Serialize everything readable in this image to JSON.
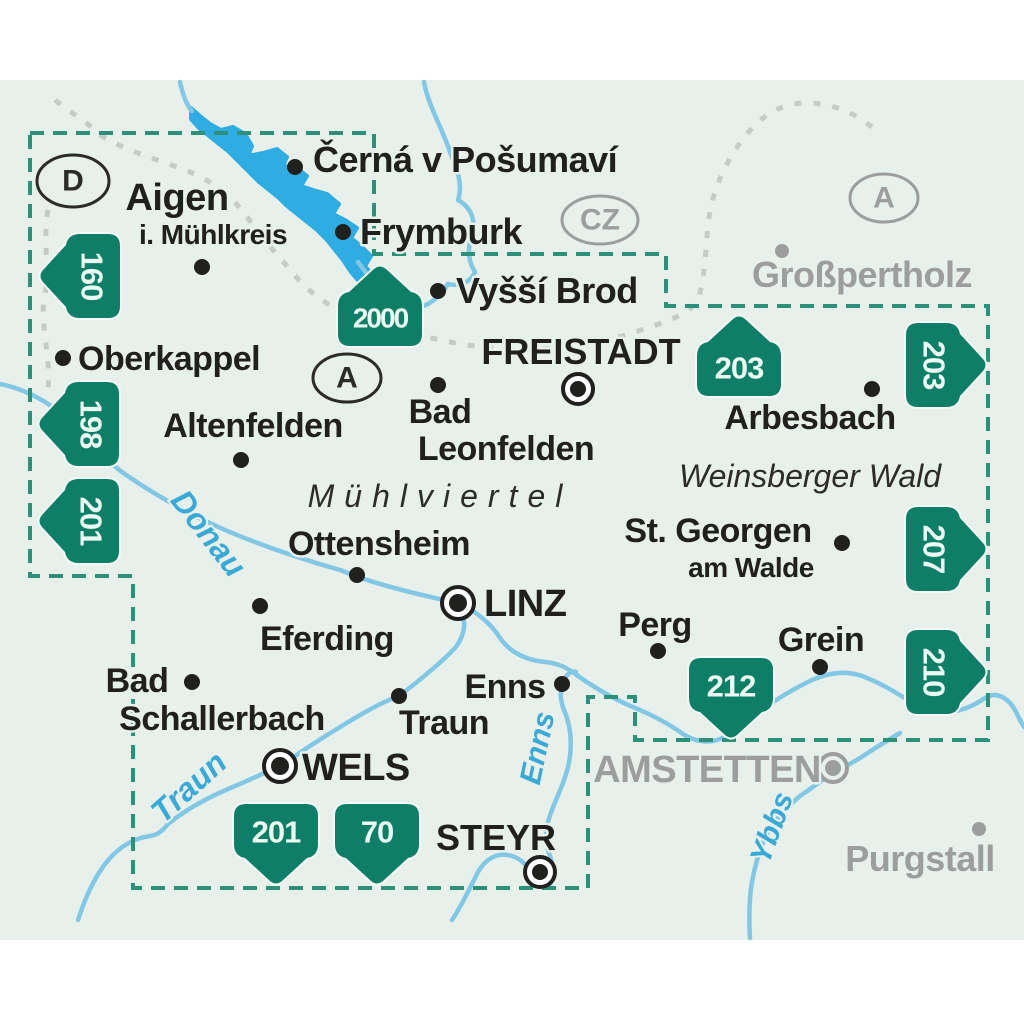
{
  "map_type": "hiking-map-overview",
  "labels": {
    "cerna": "Černá v Pošumaví",
    "aigen1": "Aigen",
    "aigen2": "i. Mühlkreis",
    "frymburk": "Frymburk",
    "vyssi": "Vyšší Brod",
    "grosspertholz": "Großpertholz",
    "oberkappel": "Oberkappel",
    "freistadt": "FREISTADT",
    "arbesbach": "Arbesbach",
    "altenfelden": "Altenfelden",
    "bad1": "Bad",
    "leonfelden": "Leonfelden",
    "stgeorgen": "St. Georgen",
    "amwalde": "am Walde",
    "ottensheim": "Ottensheim",
    "linz": "LINZ",
    "perg": "Perg",
    "grein": "Grein",
    "eferding": "Eferding",
    "enns_city": "Enns",
    "bad2": "Bad",
    "schallerbach": "Schallerbach",
    "traun_city": "Traun",
    "wels": "WELS",
    "amstetten": "AMSTETTEN",
    "steyr": "STEYR",
    "purgstall": "Purgstall"
  },
  "regions": {
    "muhlviertel": "Mühlviertel",
    "weinsberger_wald": "Weinsberger Wald"
  },
  "rivers": {
    "donau": "Donau",
    "traun": "Traun",
    "enns": "Enns",
    "ybbs": "Ybbs"
  },
  "countries": {
    "d": "D",
    "a_inner": "A",
    "cz": "CZ",
    "a_outer": "A"
  },
  "badges": {
    "b160": "160",
    "b198": "198",
    "b201_left": "201",
    "b2000": "2000",
    "b203_top": "203",
    "b203_right": "203",
    "b207": "207",
    "b210": "210",
    "b212": "212",
    "b201_bottom": "201",
    "b70": "70"
  },
  "colors": {
    "badge_green": "#0e7f66",
    "boundary_teal": "#2d9078",
    "river_blue": "#82c7e3",
    "lake_blue": "#2fade2",
    "town_black": "#20201e",
    "neighbor_gray": "#9b9e9c",
    "water_label_blue": "#3ba9d6",
    "background_mint": "#e8f0ec",
    "country_border_gray": "#c2c6c3"
  }
}
